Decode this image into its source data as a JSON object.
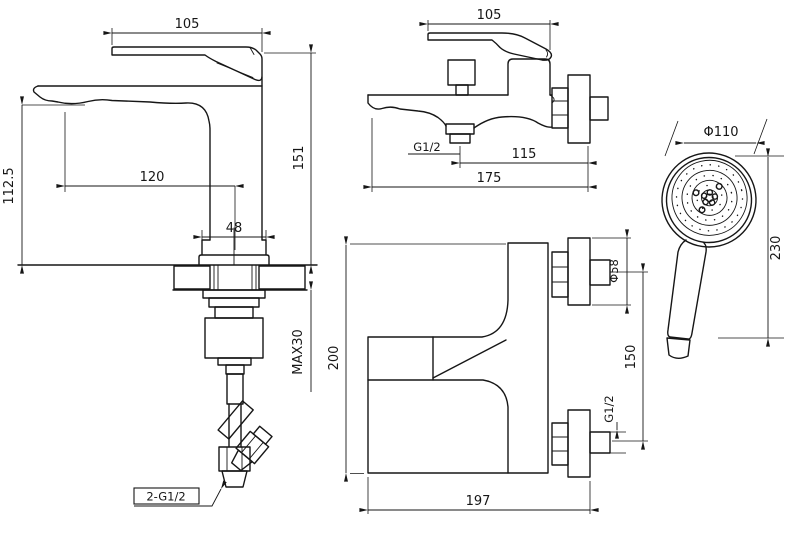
{
  "page": {
    "background": "#ffffff",
    "line_color": "#161616"
  },
  "views": {
    "basin_faucet": {
      "dims": {
        "handle_length": "105",
        "total_height": "151",
        "spout_height": "112.5",
        "spout_reach": "120",
        "base_width": "48",
        "max_deck_thickness": "MAX30",
        "hose_thread": "2-G1/2"
      }
    },
    "bath_mixer_side": {
      "dims": {
        "handle_length": "105",
        "outlet_thread": "G1/2",
        "outlet_to_wall": "115",
        "total_depth": "175"
      }
    },
    "bath_mixer_front": {
      "dims": {
        "body_height": "200",
        "body_width": "197",
        "escutcheon_size": "Φ58",
        "inlet_spacing": "150",
        "inlet_thread": "G1/2"
      }
    },
    "hand_shower": {
      "dims": {
        "head_diameter": "Φ110",
        "length": "230"
      }
    }
  }
}
